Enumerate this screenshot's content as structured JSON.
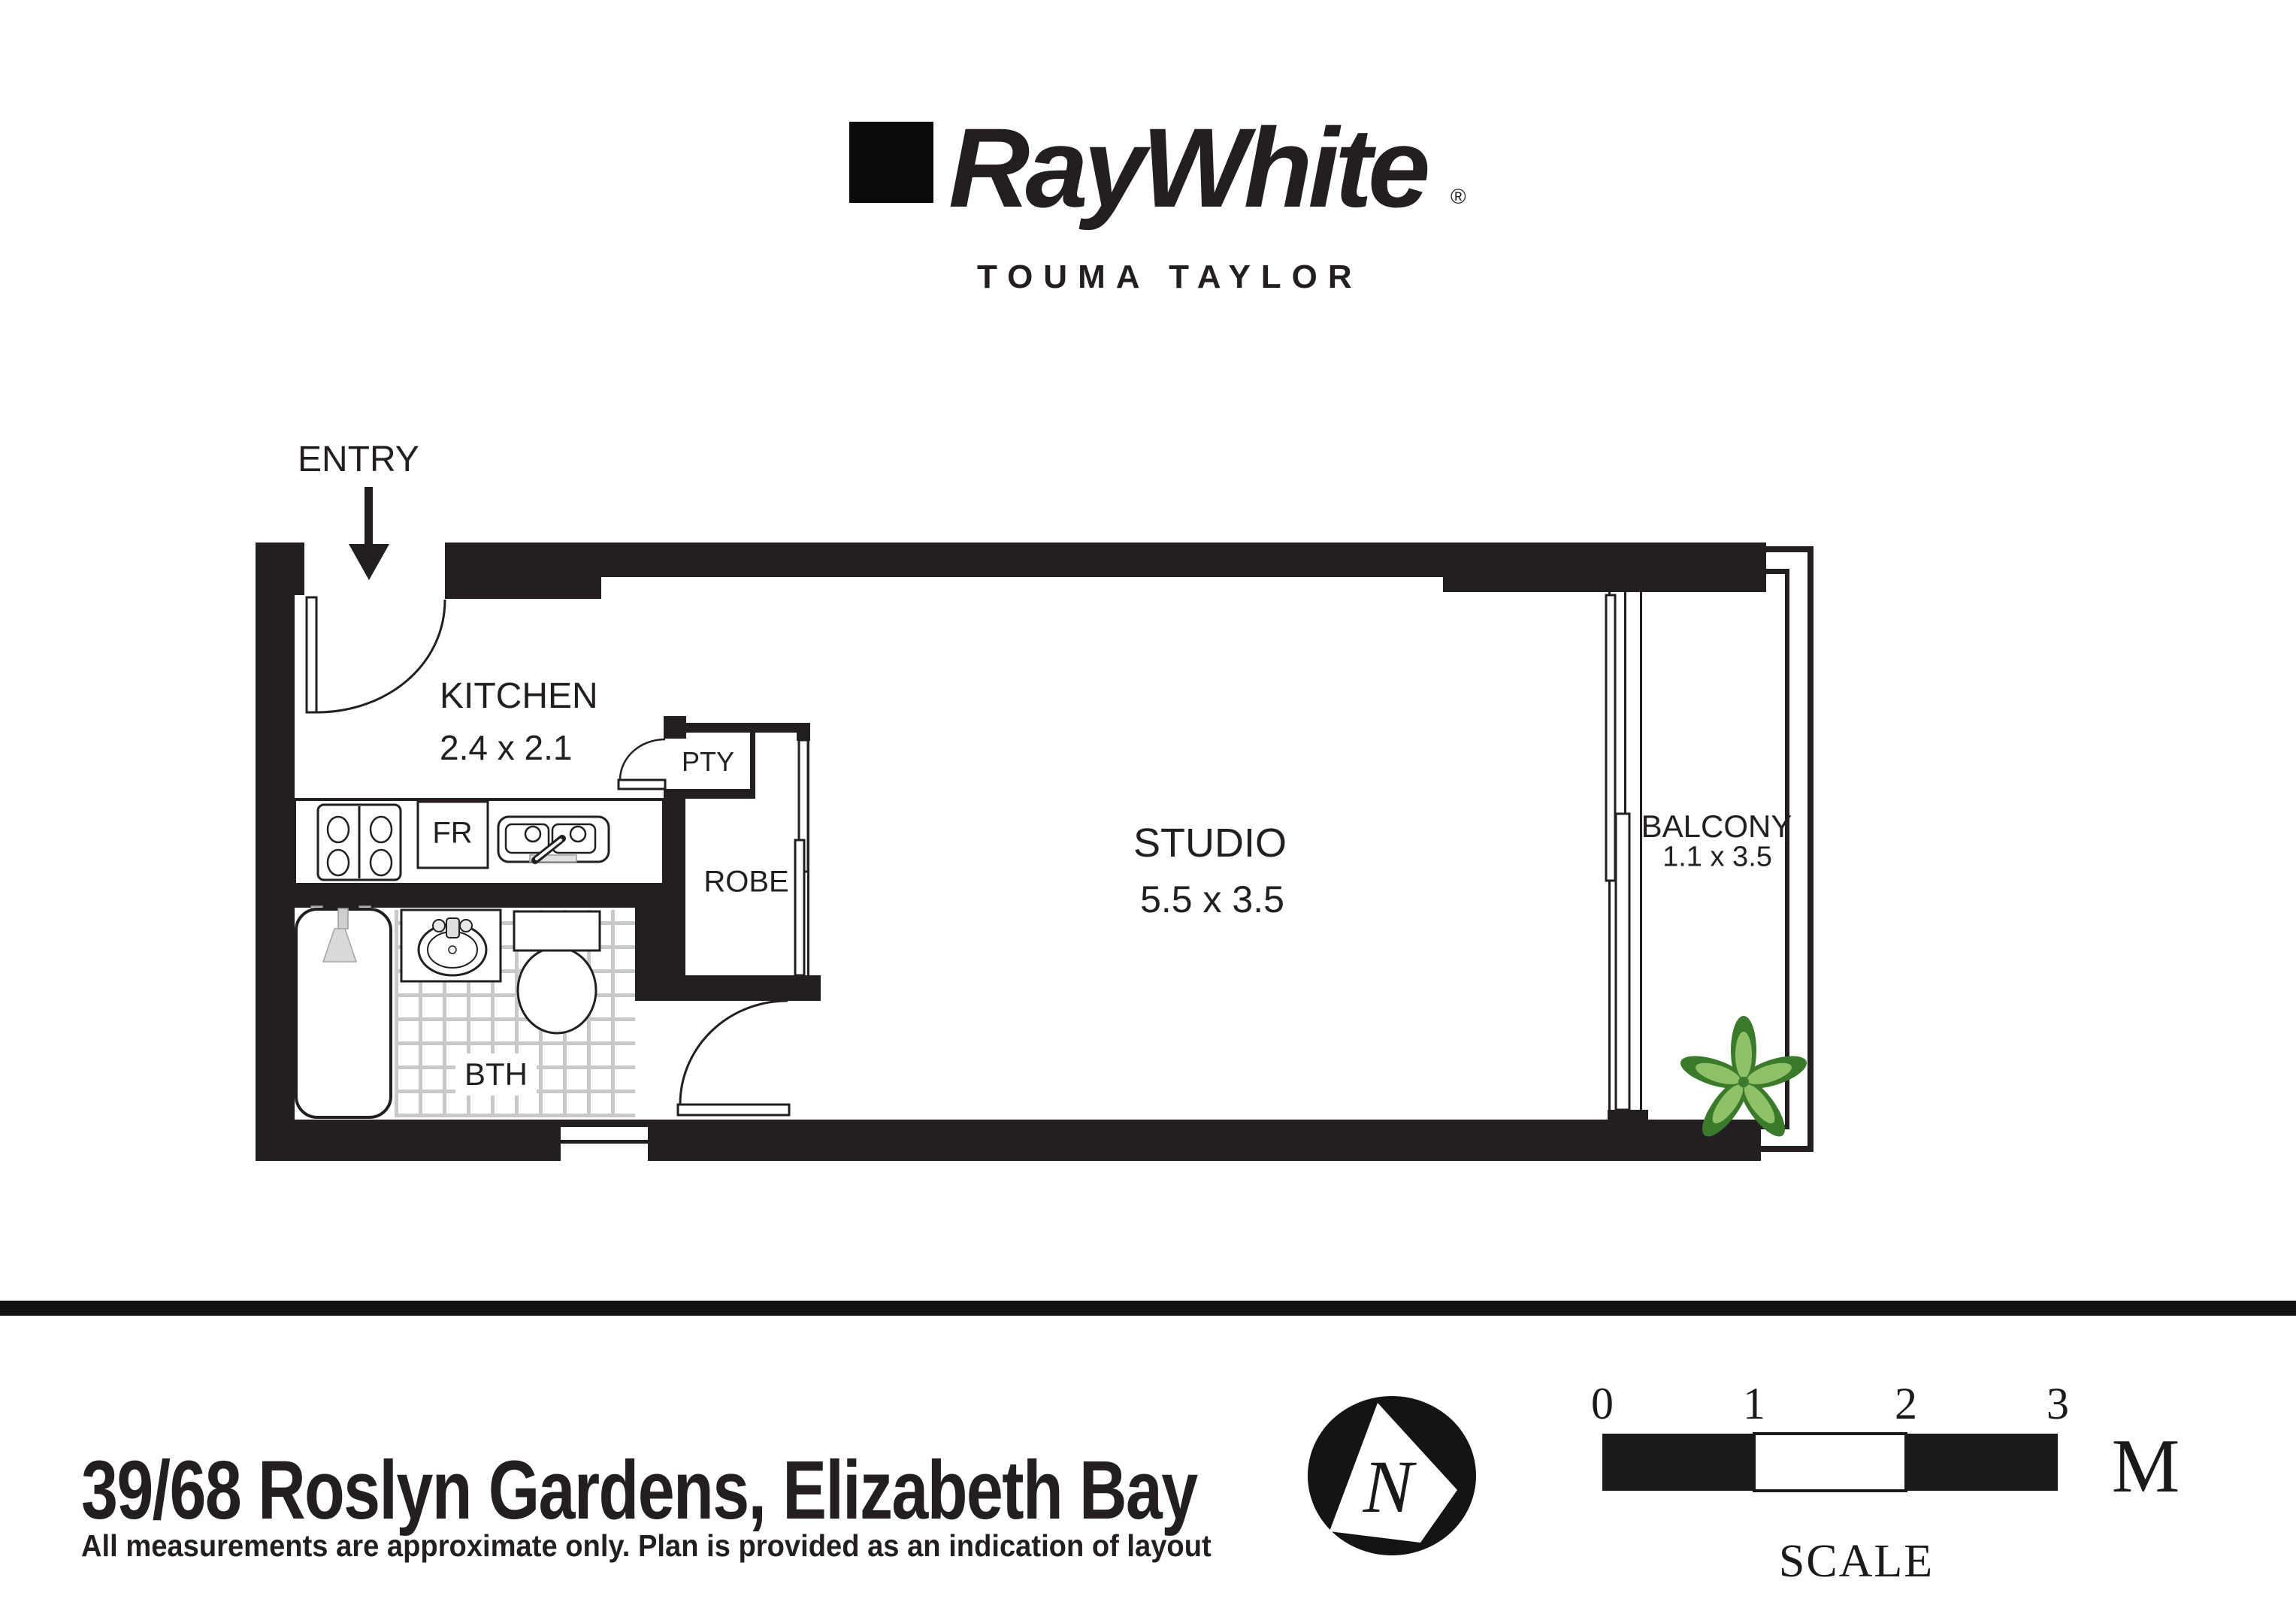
{
  "brand": {
    "wordmark": "RayWhite",
    "registered": "®",
    "office": "TOUMA TAYLOR"
  },
  "plan": {
    "entry_label": "ENTRY",
    "kitchen_name": "KITCHEN",
    "kitchen_dims": "2.4 x 2.1",
    "pantry": "PTY",
    "robe": "ROBE",
    "bath": "BTH",
    "fridge": "FR",
    "studio_name": "STUDIO",
    "studio_dims": "5.5 x 3.5",
    "balcony_name": "BALCONY",
    "balcony_dims": "1.1 x 3.5"
  },
  "compass": {
    "north": "N"
  },
  "scale_bar": {
    "ticks": [
      "0",
      "1",
      "2",
      "3"
    ],
    "unit": "M",
    "caption": "SCALE"
  },
  "footer": {
    "address": "39/68 Roslyn Gardens, Elizabeth Bay",
    "disclaimer": "All measurements are approximate only. Plan is provided as an indication of layout"
  },
  "colors": {
    "ink": "#231f20",
    "plant_dark": "#3a7a2a",
    "plant_light": "#8fc266",
    "tile_line": "#c9c9c9"
  }
}
